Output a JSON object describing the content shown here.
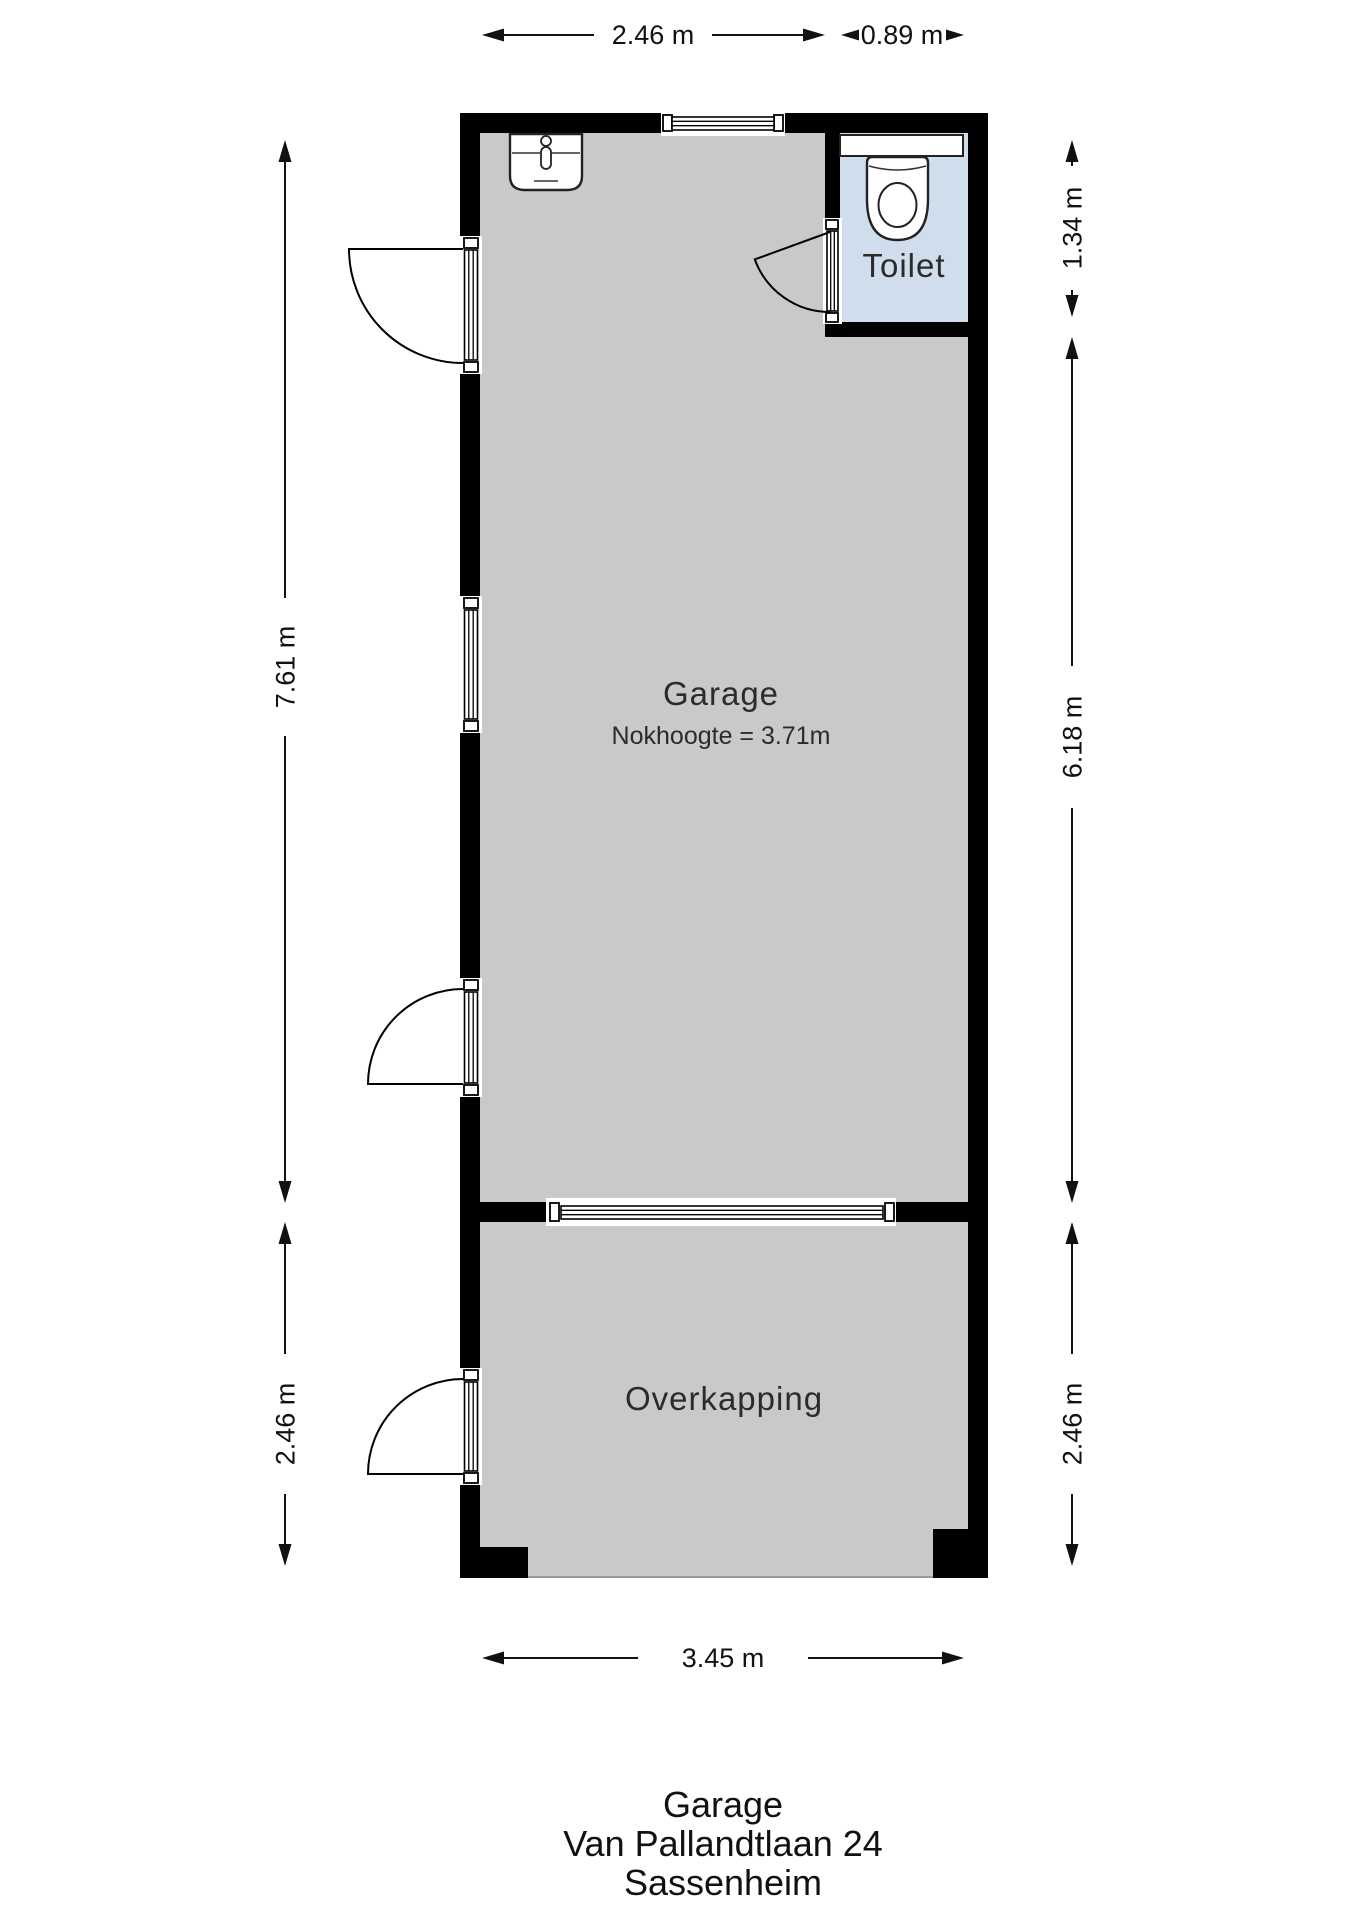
{
  "plan_title": {
    "line1": "Garage",
    "line2": "Van Pallandtlaan 24",
    "line3": "Sassenheim"
  },
  "rooms": {
    "garage": {
      "label": "Garage",
      "note": "Nokhoogte = 3.71m"
    },
    "toilet": {
      "label": "Toilet"
    },
    "overkapping": {
      "label": "Overkapping"
    }
  },
  "dimensions": {
    "top_garage_width": "2.46 m",
    "top_toilet_width": "0.89 m",
    "left_garage_length": "7.61 m",
    "left_overkapping_length": "2.46 m",
    "right_toilet_length": "1.34 m",
    "right_garage_length": "6.18 m",
    "right_overkapping_length": "2.46 m",
    "bottom_width": "3.45 m"
  },
  "fixtures": {
    "sink": "sink",
    "toilet": "toilet"
  },
  "colors": {
    "wall": "#000000",
    "floor_garage": "#c9c9c9",
    "floor_toilet": "#cfdded",
    "background": "#ffffff",
    "dimension": "#111111"
  }
}
